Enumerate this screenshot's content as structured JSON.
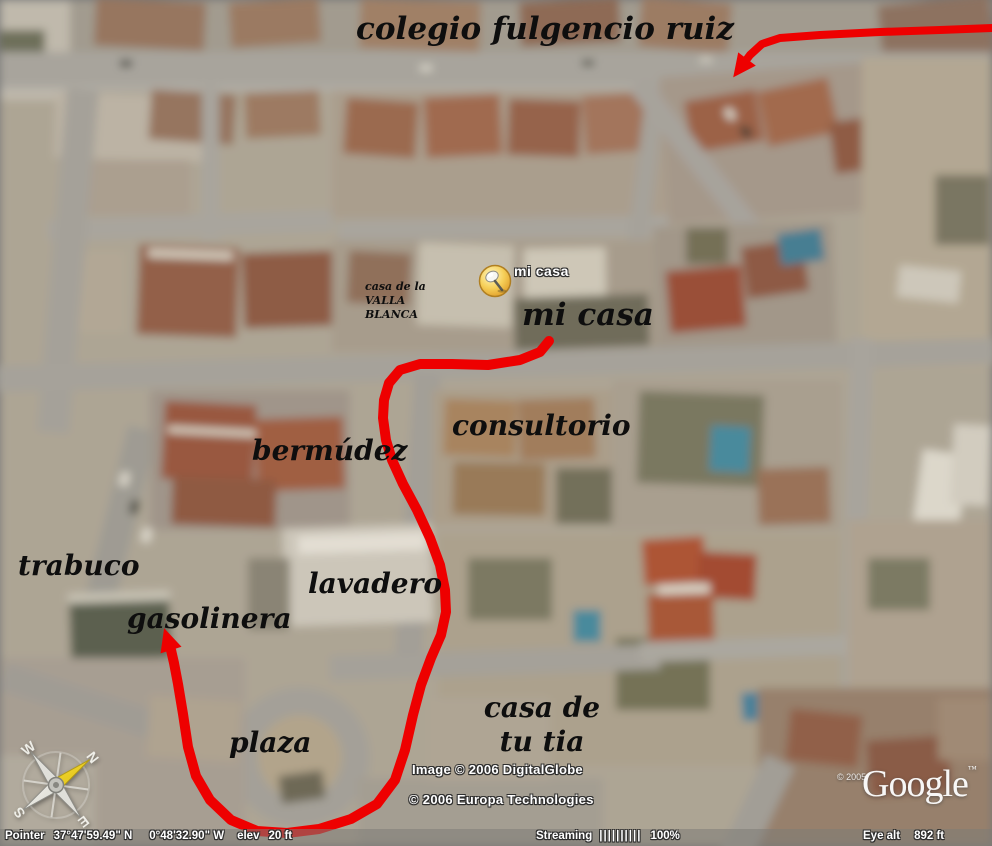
{
  "colors": {
    "route": "#ee0000",
    "map_label_text": "#0e0e0e",
    "overlay_text": "#ffffff",
    "pushpin_yellow": "#f0b93c"
  },
  "placemark": {
    "icon": "pushpin-icon",
    "label": "mi casa"
  },
  "map_labels": {
    "colegio": "colegio fulgencio ruiz",
    "mi_casa": "mi casa",
    "casa_valla": {
      "line1": "casa de la",
      "line2": "VALLA",
      "line3": "BLANCA"
    },
    "consultorio": "consultorio",
    "bermudez": "bermúdez",
    "trabuco": "trabuco",
    "lavadero": "lavadero",
    "gasolinera": "gasolinera",
    "plaza": "plaza",
    "casa_tia": {
      "line1": "casa de",
      "line2": "tu tia"
    }
  },
  "route": {
    "color": "#ee0000",
    "main_width": 10,
    "top_width": 8,
    "main_path": [
      [
        549,
        341
      ],
      [
        540,
        352
      ],
      [
        520,
        360
      ],
      [
        488,
        365
      ],
      [
        452,
        364
      ],
      [
        420,
        364
      ],
      [
        400,
        370
      ],
      [
        389,
        383
      ],
      [
        384,
        400
      ],
      [
        383,
        418
      ],
      [
        386,
        440
      ],
      [
        392,
        460
      ],
      [
        403,
        484
      ],
      [
        417,
        510
      ],
      [
        430,
        538
      ],
      [
        440,
        565
      ],
      [
        445,
        590
      ],
      [
        446,
        612
      ],
      [
        441,
        635
      ],
      [
        431,
        658
      ],
      [
        421,
        685
      ],
      [
        413,
        715
      ],
      [
        405,
        750
      ],
      [
        395,
        780
      ],
      [
        377,
        804
      ],
      [
        351,
        819
      ],
      [
        319,
        829
      ],
      [
        287,
        833
      ],
      [
        257,
        831
      ],
      [
        231,
        820
      ],
      [
        210,
        800
      ],
      [
        196,
        776
      ],
      [
        188,
        747
      ],
      [
        183,
        714
      ],
      [
        178,
        684
      ],
      [
        174,
        663
      ],
      [
        171,
        650
      ]
    ],
    "main_arrow_tip": [
      165,
      631
    ],
    "top_path": [
      [
        992,
        28
      ],
      [
        940,
        30
      ],
      [
        880,
        32
      ],
      [
        820,
        35
      ],
      [
        780,
        38
      ],
      [
        762,
        44
      ],
      [
        750,
        55
      ],
      [
        744,
        63
      ]
    ],
    "top_arrow_tip": [
      735,
      75
    ]
  },
  "compass": {
    "icon": "compass-rose-icon",
    "n": "N",
    "e": "E",
    "s": "S",
    "w": "W"
  },
  "attribution": {
    "imagery": "Image © 2006 DigitalGlobe",
    "provider": "© 2006 Europa Technologies",
    "logo_year": "© 2005",
    "logo_text": "Google",
    "logo_tm": "™"
  },
  "status_bar": {
    "pointer_label": "Pointer",
    "latitude": "37°47'59.49\" N",
    "longitude": "0°48'32.90\" W",
    "elev_label": "elev",
    "elev_value": "20 ft",
    "streaming_label": "Streaming",
    "streaming_bars": "||||||||||",
    "streaming_percent": "100%",
    "eye_alt_label": "Eye alt",
    "eye_alt_value": "892 ft"
  }
}
